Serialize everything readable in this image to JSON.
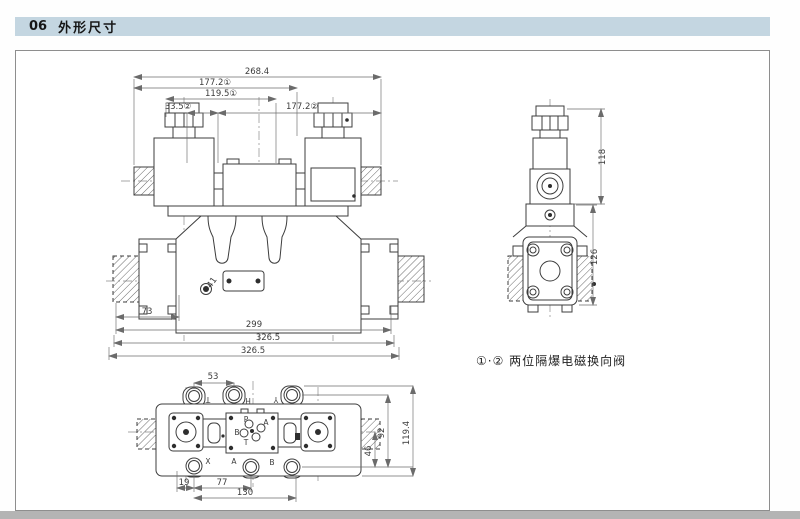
{
  "page": {
    "section_number": "06",
    "section_title": "外形尺寸",
    "note": "①·② 两位隔爆电磁换向阀"
  },
  "front_view": {
    "dim_total_width": "268.4",
    "dim_width_177_1": "177.2①",
    "dim_width_119_5": "119.5①",
    "dim_width_33_5": "33.5②",
    "dim_width_177_2": "177.2②",
    "dim_73": "73",
    "dim_299": "299",
    "dim_326_a": "326.5",
    "dim_326_b": "326.5",
    "hole_label": "41"
  },
  "side_view": {
    "dim_height_top": "118",
    "dim_height_bottom": "126"
  },
  "bottom_view": {
    "dim_53": "53",
    "dim_19": "19",
    "dim_77": "77",
    "dim_130": "130",
    "dim_46": "46",
    "dim_92": "92",
    "dim_119_4": "119.4",
    "port_top_left": "T",
    "port_top_mid": "H",
    "port_top_right": "Y",
    "port_bottom_left": "X",
    "port_bottom_mid": "A",
    "port_bottom_right": "B",
    "face_port_p": "P",
    "face_port_a": "A",
    "face_port_b": "B",
    "face_port_t": "T"
  },
  "colors": {
    "header_bg": "#c4d6e1",
    "line": "#3d3d3d",
    "dim_line": "#6b6b6b",
    "page_edge": "#b4b4b4"
  }
}
